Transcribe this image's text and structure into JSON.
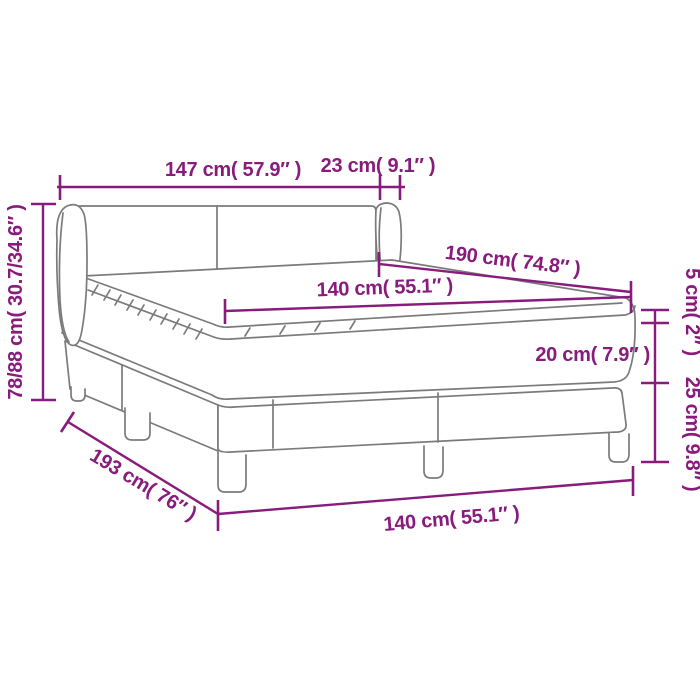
{
  "figure": {
    "subject": "box-spring-bed-dimension-diagram",
    "background_color": "#ffffff",
    "dimension_color": "#881b7c",
    "drawing_color": "#7b7b7b",
    "labels": {
      "headboard_width": "147 cm( 57.9″ )",
      "headboard_wing_depth": "23 cm( 9.1″ )",
      "headboard_height": "78/88 cm( 30.7/34.6″ )",
      "bed_length": "190 cm( 74.8″ )",
      "mattress_width_top": "140 cm( 55.1″ )",
      "topper_height": "5 cm( 2″ )",
      "mattress_height": "20 cm( 7.9″ )",
      "base_height": "25 cm( 9.8″ )",
      "base_length": "193 cm( 76″ )",
      "base_width_bottom": "140 cm( 55.1″ )"
    }
  }
}
